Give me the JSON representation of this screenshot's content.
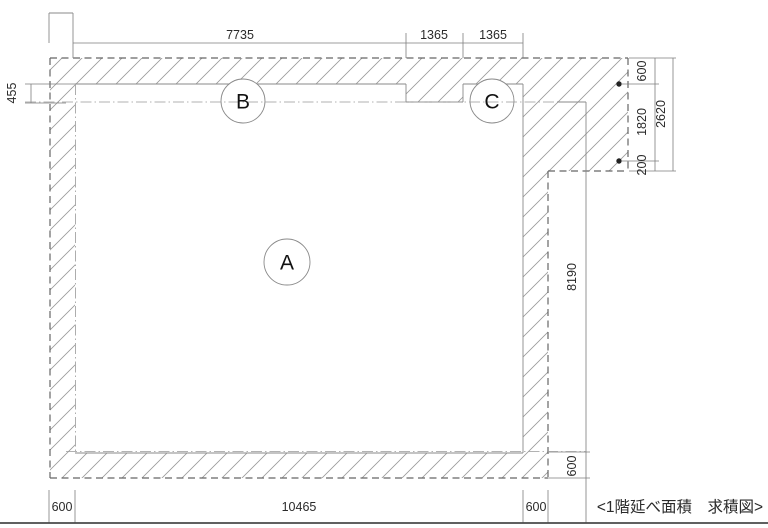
{
  "drawing": {
    "title": "<1階延べ面積　求積図>",
    "region_labels": {
      "a": "A",
      "b": "B",
      "c": "C"
    },
    "dimensions": {
      "top_width_main": "7735",
      "top_width_seg1": "1365",
      "top_width_seg2": "1365",
      "left_overhang": "455",
      "right_top": "600",
      "right_mid": "1820",
      "right_small": "200",
      "right_total": "2620",
      "right_height": "8190",
      "right_bottom_wall": "600",
      "bottom_left_wall": "600",
      "bottom_width": "10465",
      "bottom_right_wall": "600"
    },
    "colors": {
      "background": "#ffffff",
      "wall_hatch": "#9a9a9a",
      "outer_boundary": "#666666",
      "thin_line": "#8a8a8a",
      "dimension_text": "#2a2a2a",
      "frame_line": "#4a4a4a"
    }
  }
}
